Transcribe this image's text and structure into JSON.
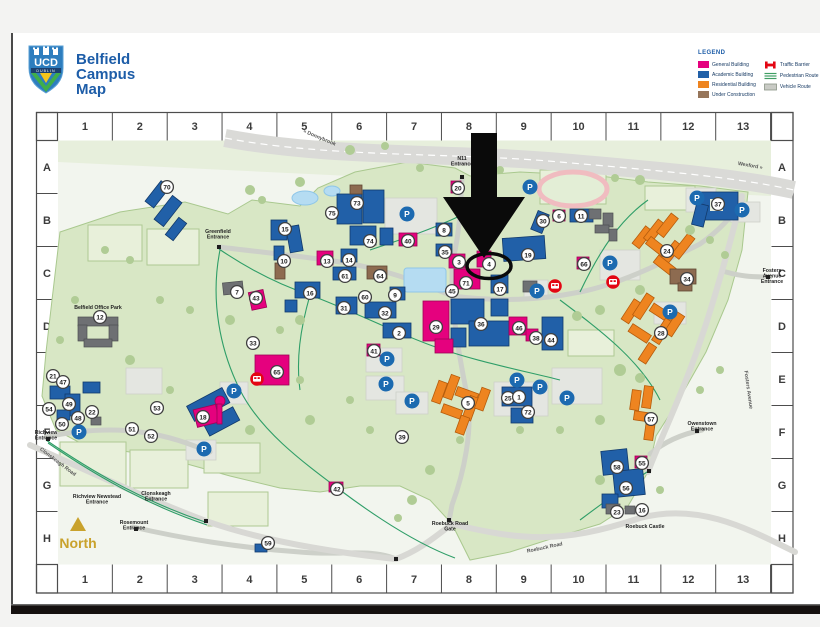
{
  "header": {
    "title_line1": "Belfield",
    "title_line2": "Campus",
    "title_line3": "Map",
    "logo_text": "UCD",
    "logo_subtext": "DUBLIN"
  },
  "legend": {
    "title": "LEGEND",
    "building_types": [
      {
        "label": "General Building",
        "color": "#e5017e"
      },
      {
        "label": "Academic Building",
        "color": "#2160a8"
      },
      {
        "label": "Residential Building",
        "color": "#ee8420"
      },
      {
        "label": "Under Construction",
        "color": "#96755a"
      }
    ],
    "route_types": [
      {
        "label": "Traffic Barrier",
        "color": "#e30613",
        "icon": "traffic-barrier-icon"
      },
      {
        "label": "Pedestrian Route",
        "color": "#3f9e63",
        "icon": "pedestrian-route-icon"
      },
      {
        "label": "Vehicle Route",
        "color": "#c9cbc5",
        "icon": "vehicle-route-icon"
      }
    ]
  },
  "grid": {
    "columns": [
      "1",
      "2",
      "3",
      "4",
      "5",
      "6",
      "7",
      "8",
      "9",
      "10",
      "11",
      "12",
      "13"
    ],
    "rows": [
      "A",
      "B",
      "C",
      "D",
      "E",
      "F",
      "G",
      "H"
    ]
  },
  "map": {
    "north_label": "North",
    "parking_symbol": "P",
    "annotation": {
      "type": "arrow-and-circle",
      "points_to_marker": "4"
    },
    "labels": [
      {
        "text": "« Donnybrook",
        "x": 319,
        "y": 139,
        "rotate": 23,
        "road": true
      },
      {
        "text": "Wexford »",
        "x": 750,
        "y": 167,
        "rotate": 10,
        "road": true
      },
      {
        "text": "N11\nEntrance",
        "x": 462,
        "y": 160
      },
      {
        "text": "Greenfield\nEntrance",
        "x": 218,
        "y": 233
      },
      {
        "text": "Belfield Office Park",
        "x": 98,
        "y": 309
      },
      {
        "text": "Fosters\nAvenue\nEntrance",
        "x": 772,
        "y": 272
      },
      {
        "text": "Owenstown\nEntrance",
        "x": 702,
        "y": 425
      },
      {
        "text": "Richview\nEntrance",
        "x": 46,
        "y": 434
      },
      {
        "text": "Clonskeagh Road",
        "x": 57,
        "y": 463,
        "rotate": 37,
        "road": true
      },
      {
        "text": "Richview Newstead\nEntrance",
        "x": 97,
        "y": 498
      },
      {
        "text": "Clonskeagh\nEntrance",
        "x": 156,
        "y": 495
      },
      {
        "text": "Rosemount\nEntrance",
        "x": 134,
        "y": 524
      },
      {
        "text": "Roebuck Castle",
        "x": 645,
        "y": 528
      },
      {
        "text": "Roebuck Road\nGate",
        "x": 450,
        "y": 525
      },
      {
        "text": "Roebuck Road",
        "x": 545,
        "y": 549,
        "rotate": -12,
        "road": true
      },
      {
        "text": "Fosters Avenue",
        "x": 747,
        "y": 390,
        "rotate": 82,
        "road": true
      }
    ],
    "markers": [
      {
        "n": "70",
        "x": 167,
        "y": 187
      },
      {
        "n": "20",
        "x": 458,
        "y": 188
      },
      {
        "n": "73",
        "x": 357,
        "y": 203
      },
      {
        "n": "37",
        "x": 718,
        "y": 204
      },
      {
        "n": "75",
        "x": 332,
        "y": 213
      },
      {
        "n": "6",
        "x": 559,
        "y": 216
      },
      {
        "n": "11",
        "x": 581,
        "y": 216
      },
      {
        "n": "30",
        "x": 543,
        "y": 221
      },
      {
        "n": "15",
        "x": 285,
        "y": 229
      },
      {
        "n": "8",
        "x": 444,
        "y": 230
      },
      {
        "n": "74",
        "x": 370,
        "y": 241
      },
      {
        "n": "40",
        "x": 408,
        "y": 241
      },
      {
        "n": "24",
        "x": 667,
        "y": 251
      },
      {
        "n": "35",
        "x": 445,
        "y": 252
      },
      {
        "n": "19",
        "x": 528,
        "y": 255
      },
      {
        "n": "10",
        "x": 284,
        "y": 261
      },
      {
        "n": "13",
        "x": 327,
        "y": 261
      },
      {
        "n": "14",
        "x": 349,
        "y": 260
      },
      {
        "n": "3",
        "x": 459,
        "y": 262
      },
      {
        "n": "4",
        "x": 489,
        "y": 264,
        "circled": true
      },
      {
        "n": "66",
        "x": 584,
        "y": 264
      },
      {
        "n": "61",
        "x": 345,
        "y": 276
      },
      {
        "n": "64",
        "x": 380,
        "y": 276
      },
      {
        "n": "34",
        "x": 687,
        "y": 279
      },
      {
        "n": "71",
        "x": 466,
        "y": 283
      },
      {
        "n": "17",
        "x": 500,
        "y": 289
      },
      {
        "n": "45",
        "x": 452,
        "y": 291
      },
      {
        "n": "7",
        "x": 237,
        "y": 292
      },
      {
        "n": "16",
        "x": 310,
        "y": 293
      },
      {
        "n": "9",
        "x": 395,
        "y": 295
      },
      {
        "n": "60",
        "x": 365,
        "y": 297
      },
      {
        "n": "43",
        "x": 256,
        "y": 298
      },
      {
        "n": "31",
        "x": 344,
        "y": 308
      },
      {
        "n": "32",
        "x": 385,
        "y": 313
      },
      {
        "n": "12",
        "x": 100,
        "y": 317
      },
      {
        "n": "36",
        "x": 481,
        "y": 324
      },
      {
        "n": "29",
        "x": 436,
        "y": 327
      },
      {
        "n": "46",
        "x": 519,
        "y": 328
      },
      {
        "n": "28",
        "x": 661,
        "y": 333
      },
      {
        "n": "2",
        "x": 399,
        "y": 333
      },
      {
        "n": "38",
        "x": 536,
        "y": 338
      },
      {
        "n": "44",
        "x": 551,
        "y": 340
      },
      {
        "n": "33",
        "x": 253,
        "y": 343
      },
      {
        "n": "41",
        "x": 374,
        "y": 351
      },
      {
        "n": "65",
        "x": 277,
        "y": 372
      },
      {
        "n": "21",
        "x": 53,
        "y": 376
      },
      {
        "n": "47",
        "x": 63,
        "y": 382
      },
      {
        "n": "25",
        "x": 508,
        "y": 398
      },
      {
        "n": "1",
        "x": 519,
        "y": 397
      },
      {
        "n": "5",
        "x": 468,
        "y": 403
      },
      {
        "n": "49",
        "x": 69,
        "y": 404
      },
      {
        "n": "53",
        "x": 157,
        "y": 408
      },
      {
        "n": "54",
        "x": 49,
        "y": 409
      },
      {
        "n": "22",
        "x": 92,
        "y": 412
      },
      {
        "n": "72",
        "x": 528,
        "y": 412
      },
      {
        "n": "18",
        "x": 203,
        "y": 417
      },
      {
        "n": "48",
        "x": 78,
        "y": 418
      },
      {
        "n": "57",
        "x": 651,
        "y": 419
      },
      {
        "n": "50",
        "x": 62,
        "y": 424
      },
      {
        "n": "51",
        "x": 132,
        "y": 429
      },
      {
        "n": "52",
        "x": 151,
        "y": 436
      },
      {
        "n": "39",
        "x": 402,
        "y": 437
      },
      {
        "n": "55",
        "x": 642,
        "y": 463
      },
      {
        "n": "58",
        "x": 617,
        "y": 467
      },
      {
        "n": "56",
        "x": 626,
        "y": 488
      },
      {
        "n": "42",
        "x": 337,
        "y": 489
      },
      {
        "n": "23",
        "x": 617,
        "y": 512
      },
      {
        "n": "16",
        "x": 642,
        "y": 510
      },
      {
        "n": "59",
        "x": 268,
        "y": 543
      }
    ],
    "parking": [
      {
        "x": 530,
        "y": 187
      },
      {
        "x": 407,
        "y": 214
      },
      {
        "x": 697,
        "y": 198
      },
      {
        "x": 742,
        "y": 210
      },
      {
        "x": 610,
        "y": 263
      },
      {
        "x": 537,
        "y": 291
      },
      {
        "x": 670,
        "y": 312
      },
      {
        "x": 387,
        "y": 359
      },
      {
        "x": 386,
        "y": 384
      },
      {
        "x": 517,
        "y": 380
      },
      {
        "x": 540,
        "y": 387
      },
      {
        "x": 567,
        "y": 398
      },
      {
        "x": 412,
        "y": 401
      },
      {
        "x": 79,
        "y": 432
      },
      {
        "x": 234,
        "y": 391
      },
      {
        "x": 204,
        "y": 449
      }
    ],
    "bus_stops": [
      {
        "x": 555,
        "y": 286
      },
      {
        "x": 613,
        "y": 282
      },
      {
        "x": 257,
        "y": 379
      }
    ]
  },
  "colors": {
    "accent_blue": "#1d5da8",
    "map_green": "#d8e7c5",
    "academic": "#2160a8",
    "general": "#e5017e",
    "residential": "#ee8420",
    "under_construction": "#8d6b50",
    "parking_blue": "#1c6ab0",
    "bus_red": "#e30613",
    "north_gold": "#c9a22c",
    "annotation_black": "#0a0a0a"
  }
}
